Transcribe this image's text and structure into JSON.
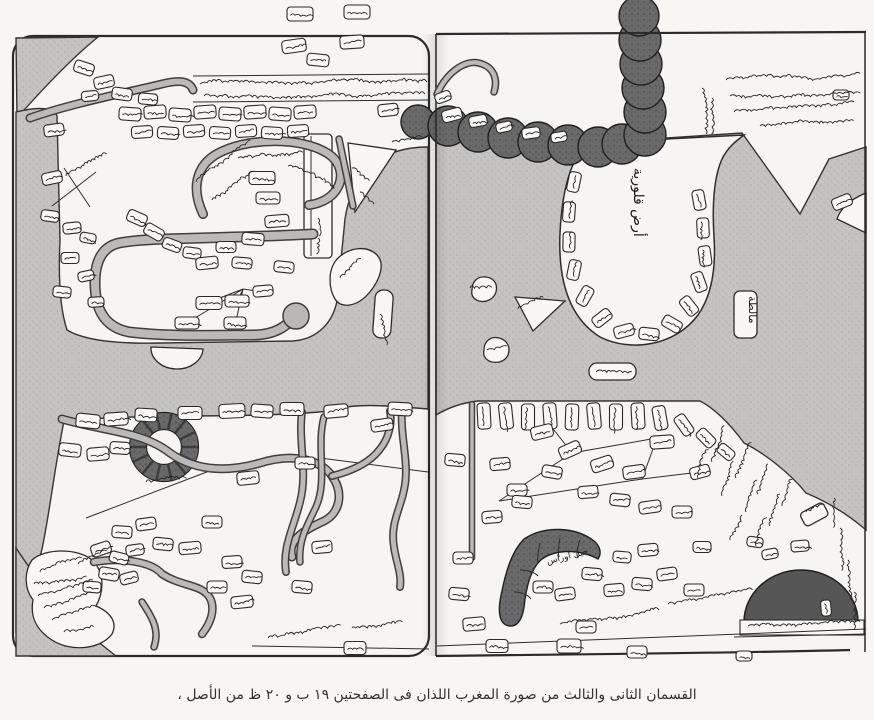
{
  "figure": {
    "caption": "القسمان الثانى والثالث من صورة المغرب اللذان فى الصفحتين ١٩ ب و ٢٠ ظ من الأصل ،"
  },
  "labels": {
    "calabria": "أرض قلورية",
    "malta": "مالطة",
    "awras_mountain": "جبل اوراس"
  },
  "colors": {
    "sea": "#c4c3c1",
    "mountain": "#6a6a6a",
    "ink": "#262626",
    "paper": "#f7f6f3"
  }
}
